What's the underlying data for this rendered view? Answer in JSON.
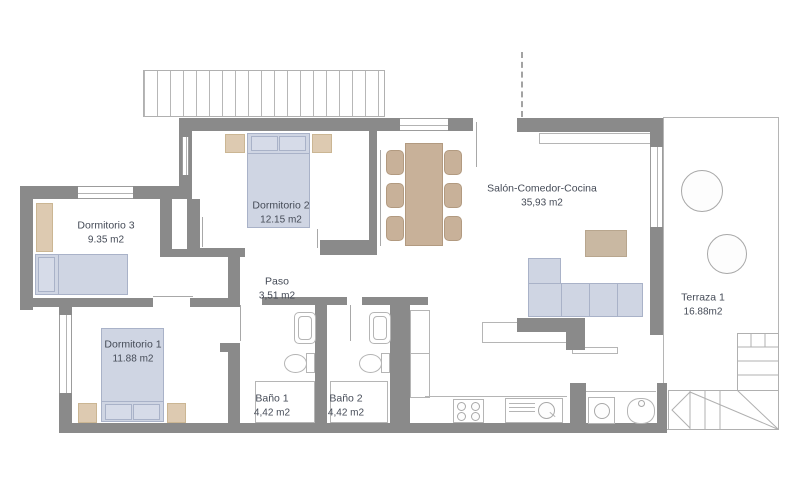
{
  "rooms": [
    {
      "name": "Dormitorio 3",
      "area": "9.35 m2"
    },
    {
      "name": "Dormitorio 2",
      "area": "12.15 m2"
    },
    {
      "name": "Dormitorio 1",
      "area": "11.88 m2"
    },
    {
      "name": "Paso",
      "area": "3,51 m2"
    },
    {
      "name": "Baño 1",
      "area": "4,42 m2"
    },
    {
      "name": "Baño 2",
      "area": "4,42 m2"
    },
    {
      "name": "Salón-Comedor-Cocina",
      "area": "35,93 m2"
    },
    {
      "name": "Terraza 1",
      "area": "16.88m2"
    }
  ],
  "colors": {
    "wall": "#8a8a8a",
    "furniture_blue": "#cfd5e3",
    "furniture_beige": "#ddcab1",
    "furniture_tan": "#c8b199",
    "thin_outline": "#b5b5b5",
    "label_text": "#454b57"
  }
}
